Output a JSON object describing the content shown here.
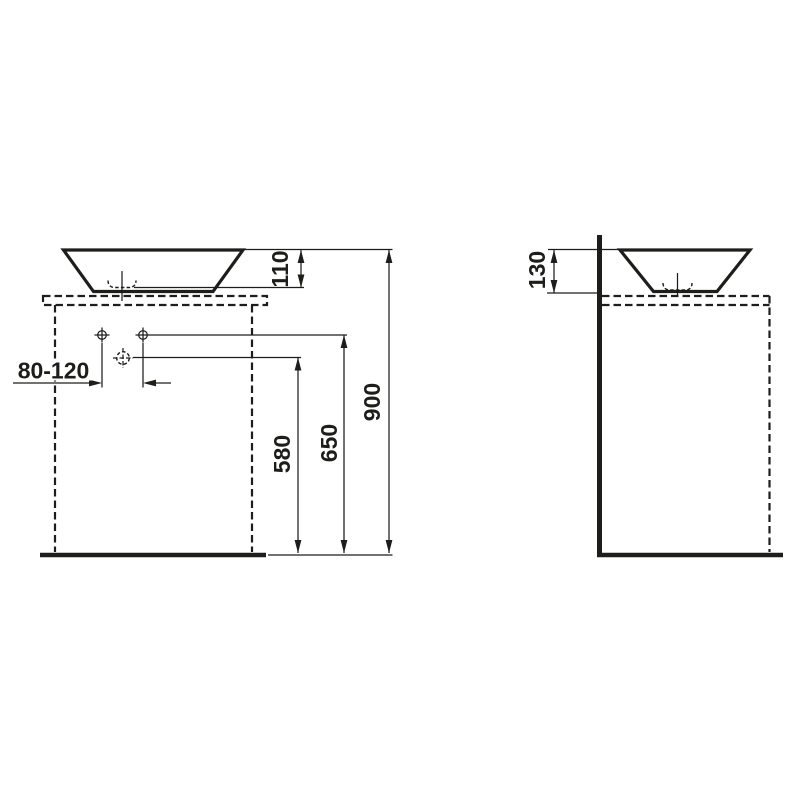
{
  "drawing": {
    "type": "washbasin installation technical drawing",
    "colors": {
      "line": "#1d1d1b",
      "background": "#ffffff"
    },
    "front_view": {
      "dim_bowl_height": "110",
      "dim_total_height": "900",
      "dim_tap_hole_height": "650",
      "dim_waste_height": "580",
      "dim_tap_hole_spacing": "80-120"
    },
    "side_view": {
      "dim_bowl_height": "130"
    }
  }
}
